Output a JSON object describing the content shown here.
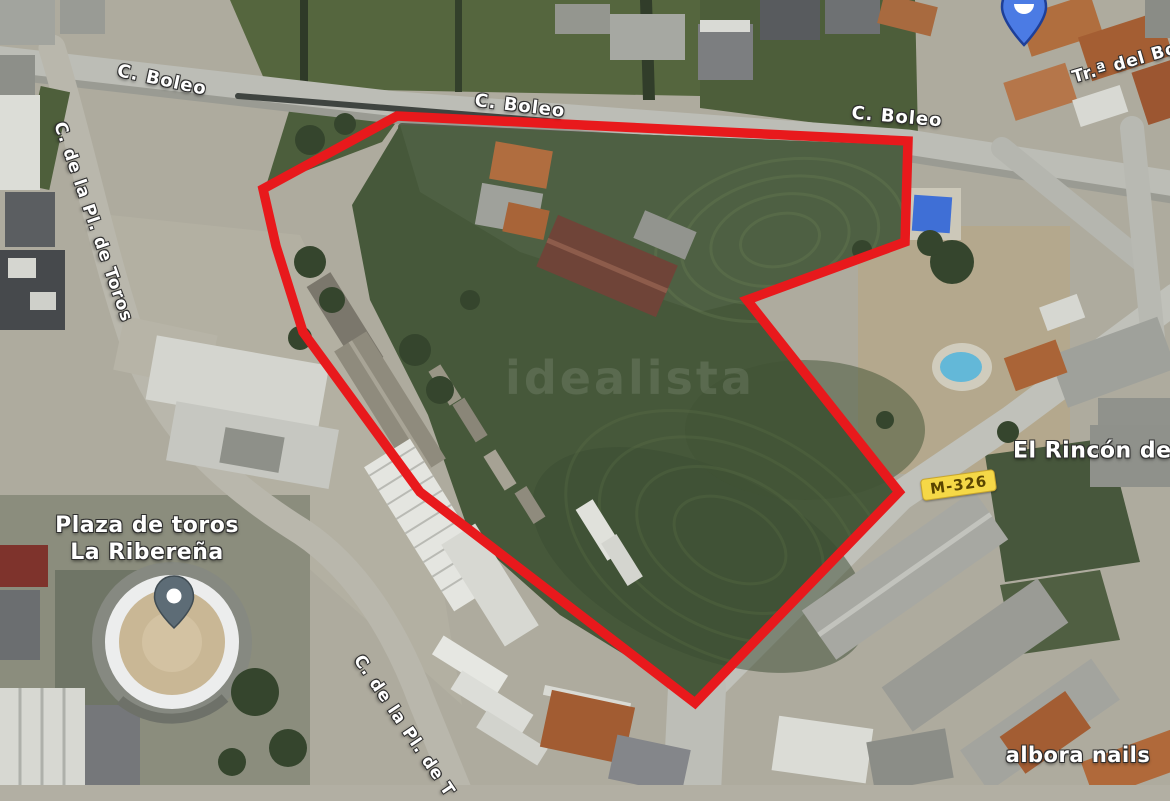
{
  "map": {
    "watermark": "idealista",
    "road_labels": [
      {
        "id": "boleo-1",
        "text": "C. Boleo"
      },
      {
        "id": "boleo-2",
        "text": "C. Boleo"
      },
      {
        "id": "boleo-3",
        "text": "C. Boleo"
      },
      {
        "id": "pl-toros-left",
        "text": "C. de la Pl. de Toros"
      },
      {
        "id": "pl-toros-bottom",
        "text": "C. de la Pl. de T"
      },
      {
        "id": "tra-del-bo",
        "text": "Tr.ª del Bo"
      }
    ],
    "place_labels": {
      "plaza_line1": "Plaza de toros",
      "plaza_line2": "La Ribereña",
      "rincon": "El Rincón de T",
      "albora": "albora nails"
    },
    "road_badge": {
      "text": "M-326",
      "bg": "#f5d847",
      "fg": "#5a4500"
    },
    "parcel_outline": {
      "color": "#e8191c",
      "stroke_width": 9.5,
      "points": "397,116 908,141 905,242 747,300 899,492 695,703 420,492 303,332 276,246 263,189"
    },
    "markers": {
      "plaza_pin_color": "#5d6c76",
      "poi_pin_color": "#4b7be4"
    }
  }
}
